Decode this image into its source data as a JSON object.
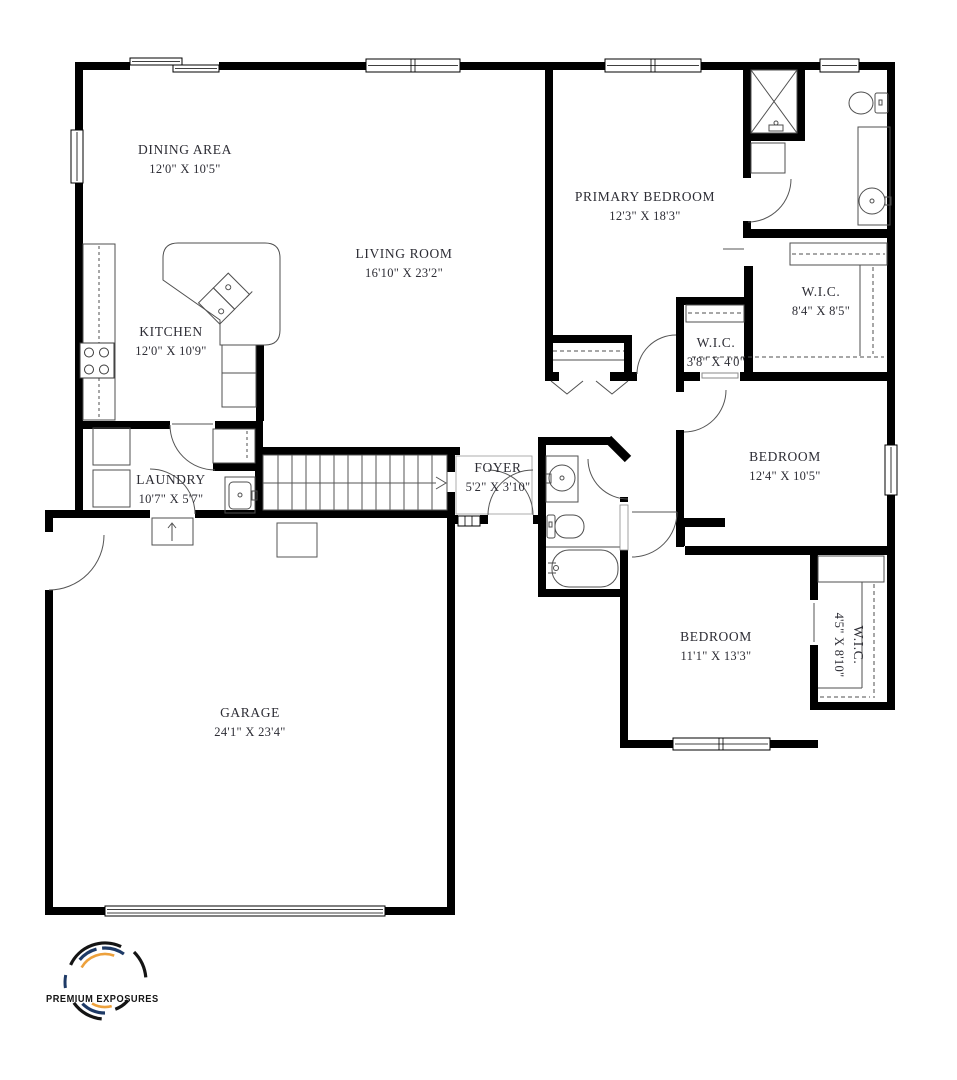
{
  "rooms": [
    {
      "id": "dining-area",
      "name": "DINING AREA",
      "dims": "12'0\" X 10'5\""
    },
    {
      "id": "kitchen",
      "name": "KITCHEN",
      "dims": "12'0\" X 10'9\""
    },
    {
      "id": "living-room",
      "name": "LIVING ROOM",
      "dims": "16'10\" X 23'2\""
    },
    {
      "id": "laundry",
      "name": "LAUNDRY",
      "dims": "10'7\" X 5'7\""
    },
    {
      "id": "foyer",
      "name": "FOYER",
      "dims": "5'2\" X 3'10\""
    },
    {
      "id": "garage",
      "name": "GARAGE",
      "dims": "24'1\" X 23'4\""
    },
    {
      "id": "primary-bedroom",
      "name": "PRIMARY BEDROOM",
      "dims": "12'3\" X 18'3\""
    },
    {
      "id": "wic-primary",
      "name": "W.I.C.",
      "dims": "8'4\" X 8'5\""
    },
    {
      "id": "wic-hall",
      "name": "W.I.C.",
      "dims": "3'8\" X 4'0\""
    },
    {
      "id": "bedroom-2",
      "name": "BEDROOM",
      "dims": "12'4\" X 10'5\""
    },
    {
      "id": "bedroom-3",
      "name": "BEDROOM",
      "dims": "11'1\" X 13'3\""
    },
    {
      "id": "wic-bedroom-3",
      "name": "W.I.C.",
      "dims": "4'5\" X 8'10\""
    }
  ],
  "logo": {
    "brand": "PREMIUM EXPOSURES"
  },
  "colors": {
    "wall": "#000000",
    "fixture_line": "#4f4f4f",
    "label_text": "#2d2d35",
    "logo_black": "#141414",
    "logo_navy": "#1e3a66",
    "logo_orange": "#eda13c"
  }
}
